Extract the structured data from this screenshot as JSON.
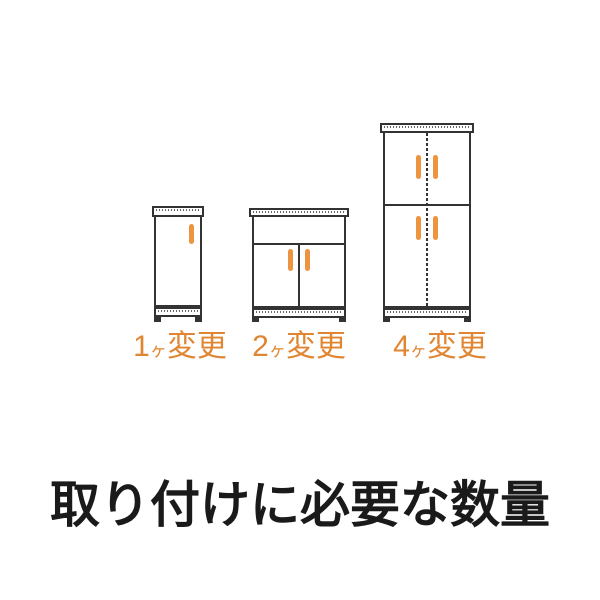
{
  "colors": {
    "background": "#FFFFFF",
    "line": "#333333",
    "handle": "#ED9440",
    "label_text": "#E08531",
    "heading_text": "#1A1A1A"
  },
  "heading": {
    "text": "取り付けに必要な数量"
  },
  "cabinets": [
    {
      "name": "single-door-cabinet",
      "handle_count": 1,
      "label": {
        "num": "1",
        "counter": "ヶ",
        "suffix": "変更"
      }
    },
    {
      "name": "two-door-cabinet",
      "handle_count": 2,
      "label": {
        "num": "2",
        "counter": "ヶ",
        "suffix": "変更"
      }
    },
    {
      "name": "four-door-cabinet",
      "handle_count": 4,
      "label": {
        "num": "4",
        "counter": "ヶ",
        "suffix": "変更"
      }
    }
  ]
}
